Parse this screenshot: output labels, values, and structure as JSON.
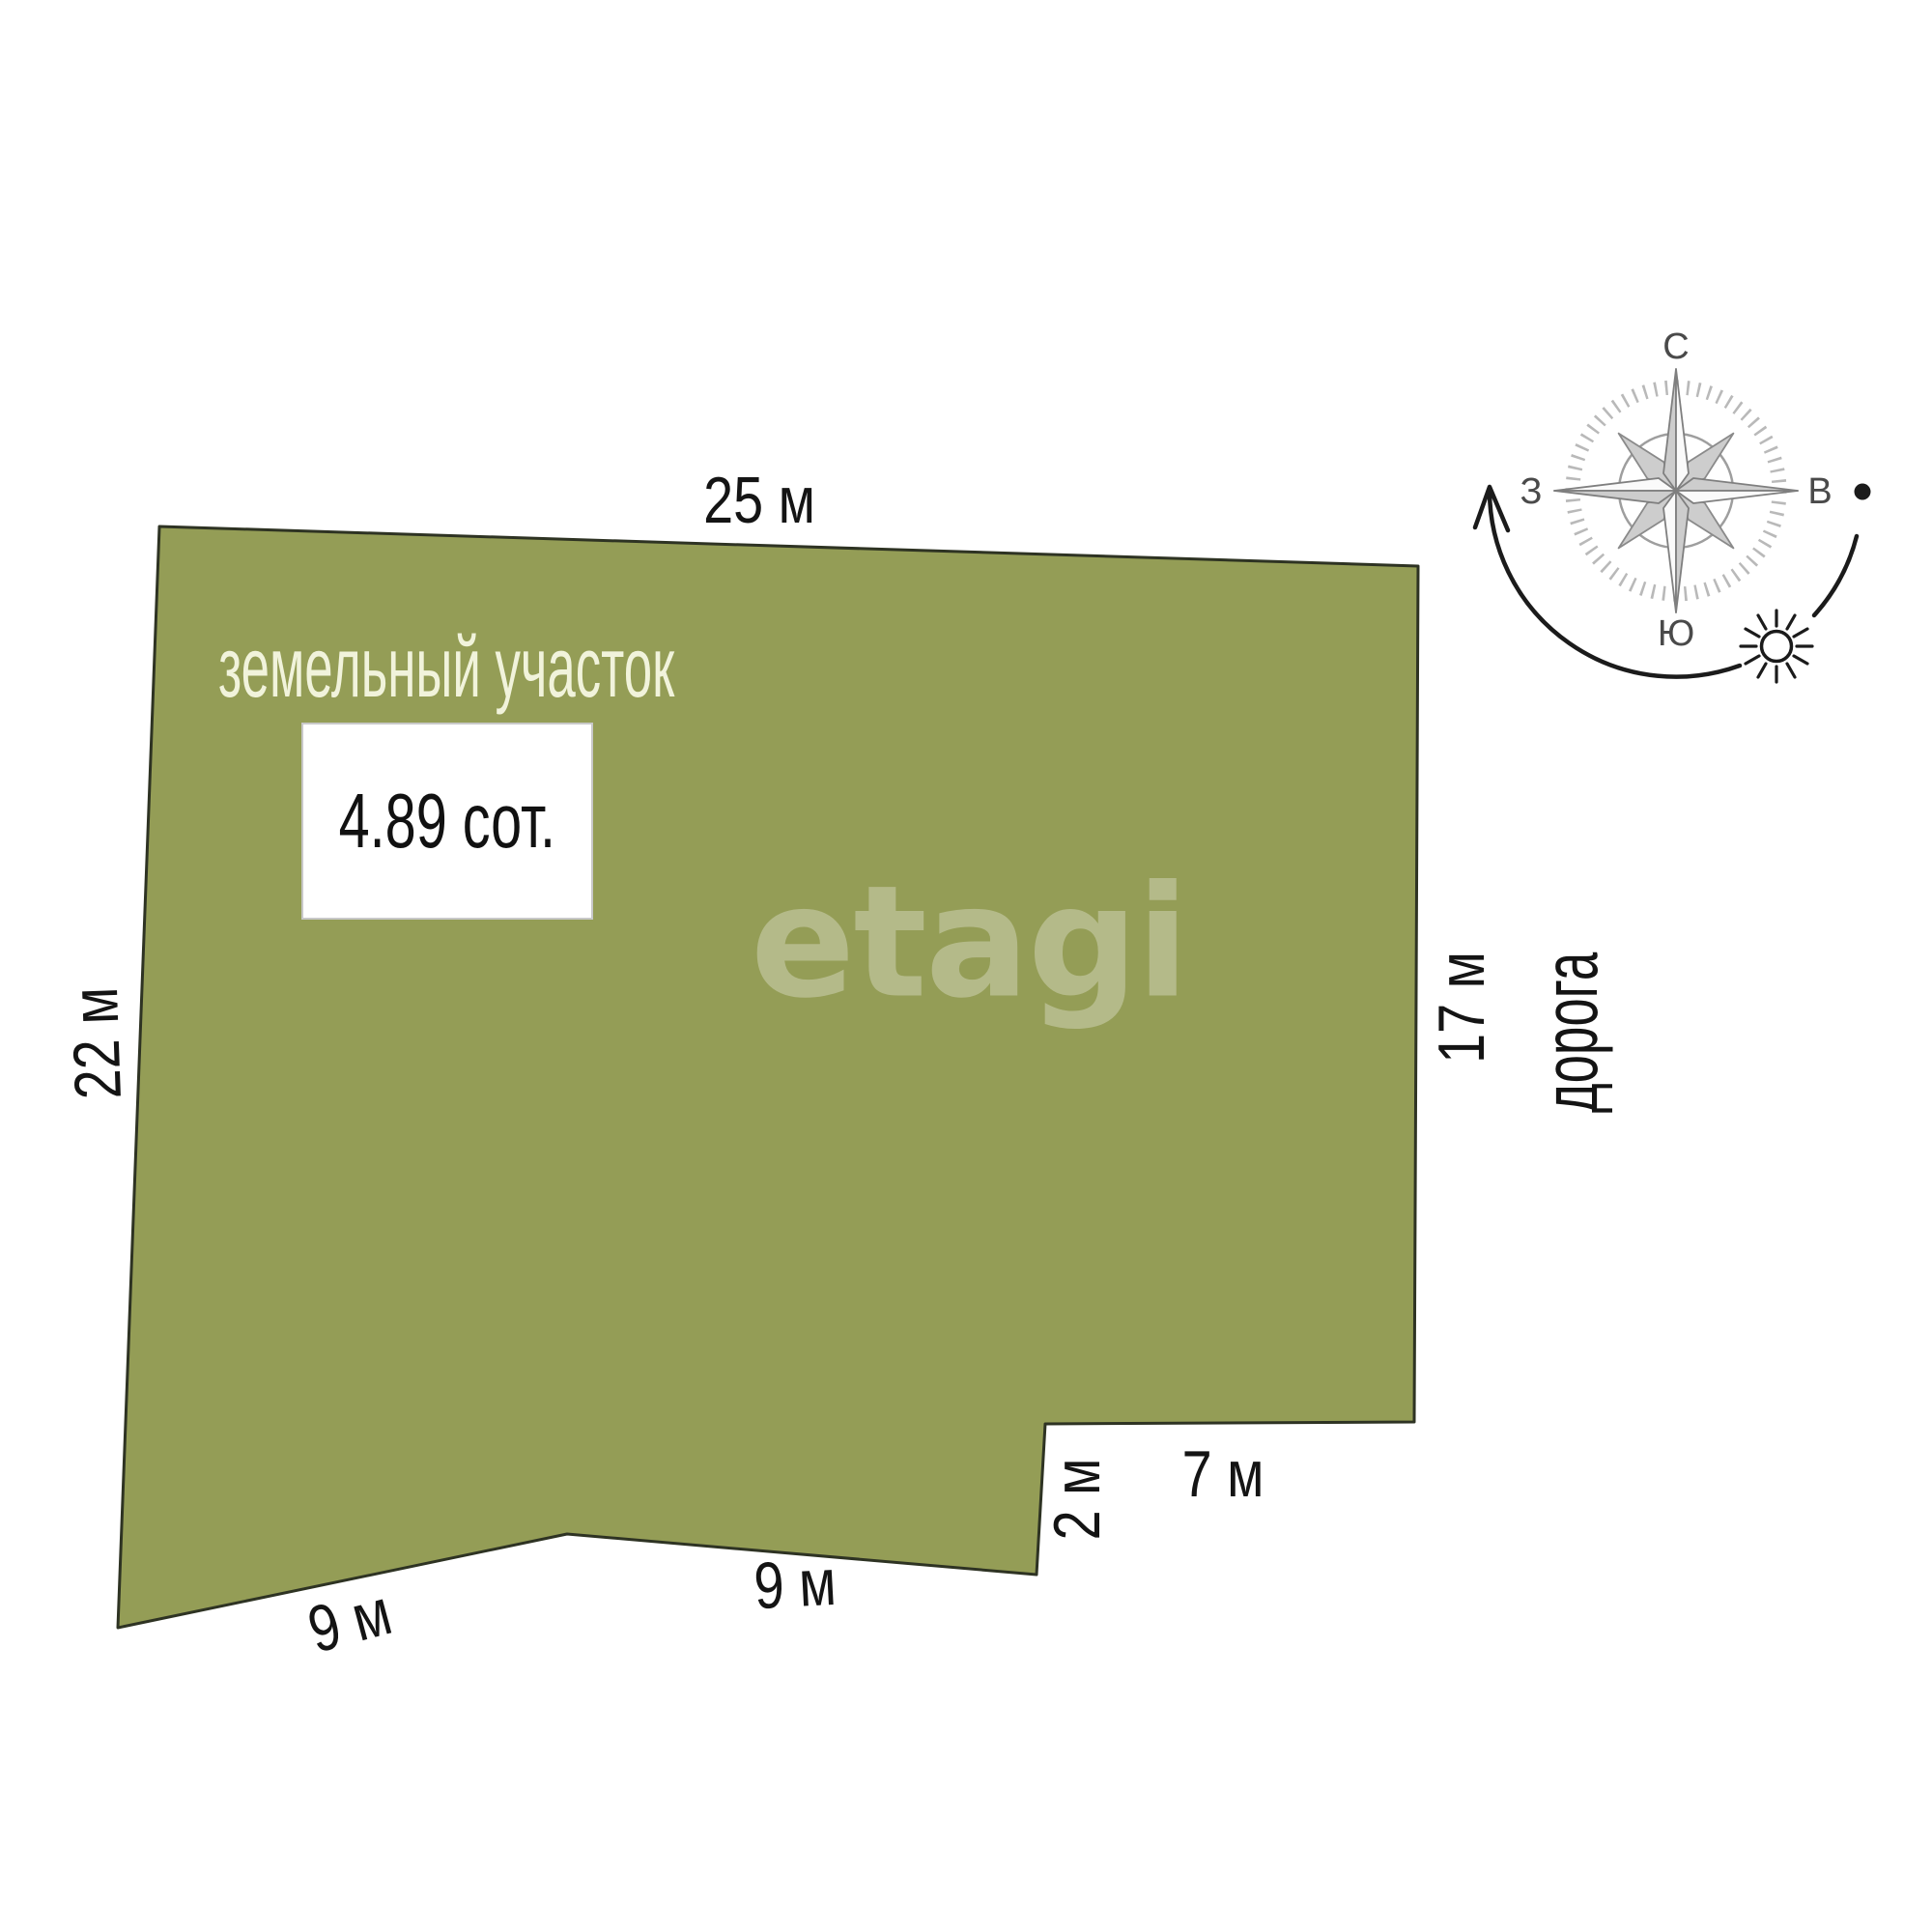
{
  "image": {
    "type": "land-plot-plan",
    "background_color": "#ffffff"
  },
  "plot": {
    "label": "земельный участок",
    "label_color": "#F1F3DB",
    "area_value": "4.89 сот.",
    "fill_color": "#949D56",
    "outline_color": "#2E3323"
  },
  "watermark": {
    "text": "etagi"
  },
  "dimensions": {
    "top_edge": "25 м",
    "left_edge": "22 м",
    "right_edge": "17 м",
    "bottom_left_edge": "9 м",
    "bottom_middle_edge": "9 м",
    "notch_vertical_edge": "2 м",
    "notch_horizontal_edge": "7 м"
  },
  "road": {
    "label": "дорога"
  },
  "compass": {
    "north_label": "С",
    "east_label": "В",
    "south_label": "Ю",
    "west_label": "З",
    "icons": [
      "compass-rose-icon",
      "sun-icon",
      "sun-path-arrow-icon",
      "east-dot-icon"
    ]
  }
}
